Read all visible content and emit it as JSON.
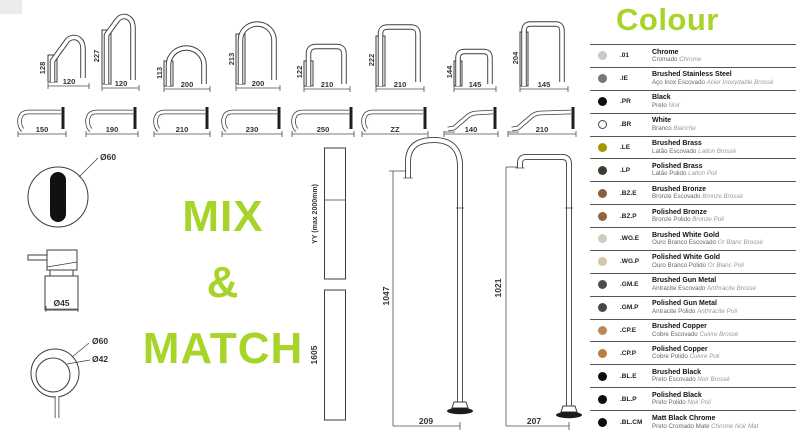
{
  "accent": "#a6d429",
  "mix_match": {
    "line1": "MIX",
    "line2": "&",
    "line3": "MATCH"
  },
  "top_spouts": [
    {
      "height": "128",
      "width": "120"
    },
    {
      "height": "227",
      "width": "120"
    },
    {
      "height": "113",
      "width": "200"
    },
    {
      "height": "213",
      "width": "200"
    },
    {
      "height": "122",
      "width": "210"
    },
    {
      "height": "222",
      "width": "210"
    },
    {
      "height": "144",
      "width": "145"
    },
    {
      "height": "204",
      "width": "145"
    }
  ],
  "wall_spouts": [
    {
      "width": "150"
    },
    {
      "width": "190"
    },
    {
      "width": "210"
    },
    {
      "width": "230"
    },
    {
      "width": "250"
    },
    {
      "width": "ZZ"
    },
    {
      "width": "140"
    },
    {
      "width": "210"
    }
  ],
  "details": {
    "face_diameter": "Ø60",
    "handle_diameter": "Ø45",
    "ring_outer": "Ø60",
    "ring_inner": "Ø42"
  },
  "risers": [
    {
      "label": "YY (max 2000mm)"
    },
    {
      "label": "1605"
    }
  ],
  "floor_spouts": [
    {
      "height": "1047",
      "width": "209"
    },
    {
      "height": "1021",
      "width": "207"
    }
  ],
  "legend": {
    "title": "Colour",
    "items": [
      {
        "code": ".01",
        "name": "Chrome",
        "sub_pt": "Cromado",
        "sub_fr": "Chrome",
        "swatch": "#c9c9c9",
        "outlined": false
      },
      {
        "code": ".IE",
        "name": "Brushed Stainless Steel",
        "sub_pt": "Aço Inox Escovado",
        "sub_fr": "Acier Inoxydable Brossé",
        "swatch": "#777777",
        "outlined": false
      },
      {
        "code": ".PR",
        "name": "Black",
        "sub_pt": "Preto",
        "sub_fr": "Noir",
        "swatch": "#0f0f0f",
        "outlined": false
      },
      {
        "code": ".BR",
        "name": "White",
        "sub_pt": "Branco",
        "sub_fr": "Blanche",
        "swatch": "#ffffff",
        "outlined": true
      },
      {
        "code": ".LE",
        "name": "Brushed Brass",
        "sub_pt": "Latão Escovado",
        "sub_fr": "Laiton Brossé",
        "swatch": "#a99500",
        "outlined": false
      },
      {
        "code": ".LP",
        "name": "Polished Brass",
        "sub_pt": "Latão Polido",
        "sub_fr": "Laiton Poli",
        "swatch": "#3d3a30",
        "outlined": false
      },
      {
        "code": ".BZ.E",
        "name": "Brushed Bronze",
        "sub_pt": "Bronze Escovado",
        "sub_fr": "Bronze Brossé",
        "swatch": "#8a5c41",
        "outlined": false
      },
      {
        "code": ".BZ.P",
        "name": "Polished Bronze",
        "sub_pt": "Bronze Polido",
        "sub_fr": "Bronze Poli",
        "swatch": "#95613f",
        "outlined": false
      },
      {
        "code": ".WG.E",
        "name": "Brushed White Gold",
        "sub_pt": "Ouro Branco Escovado",
        "sub_fr": "Or Blanc Brossé",
        "swatch": "#d4ccba",
        "outlined": false
      },
      {
        "code": ".WG.P",
        "name": "Polished White Gold",
        "sub_pt": "Ouro Branco Polido",
        "sub_fr": "Or Blanc Poli",
        "swatch": "#d2c7ab",
        "outlined": false
      },
      {
        "code": ".GM.E",
        "name": "Brushed Gun Metal",
        "sub_pt": "Antracite Escovado",
        "sub_fr": "Anthracite Brossé",
        "swatch": "#4d4d4d",
        "outlined": false
      },
      {
        "code": ".GM.P",
        "name": "Polished Gun Metal",
        "sub_pt": "Antracite Polido",
        "sub_fr": "Anthracite Poli",
        "swatch": "#474747",
        "outlined": false
      },
      {
        "code": ".CP.E",
        "name": "Brushed Copper",
        "sub_pt": "Cobre Escovado",
        "sub_fr": "Cuivre Brossé",
        "swatch": "#bb8a52",
        "outlined": false
      },
      {
        "code": ".CP.P",
        "name": "Polished Copper",
        "sub_pt": "Cobre Polido",
        "sub_fr": "Cuivre Poli",
        "swatch": "#b67f3c",
        "outlined": false
      },
      {
        "code": ".BL.E",
        "name": "Brushed Black",
        "sub_pt": "Preto Escovado",
        "sub_fr": "Noir Brossé",
        "swatch": "#0e0e0e",
        "outlined": false
      },
      {
        "code": ".BL.P",
        "name": "Polished Black",
        "sub_pt": "Preto Polido",
        "sub_fr": "Noir Poli",
        "swatch": "#0e0e0e",
        "outlined": false
      },
      {
        "code": ".BL.CM",
        "name": "Matt Black Chrome",
        "sub_pt": "Preto Cromado Mate",
        "sub_fr": "Chrome Noir Mat",
        "swatch": "#0e0e0e",
        "outlined": false
      }
    ]
  }
}
